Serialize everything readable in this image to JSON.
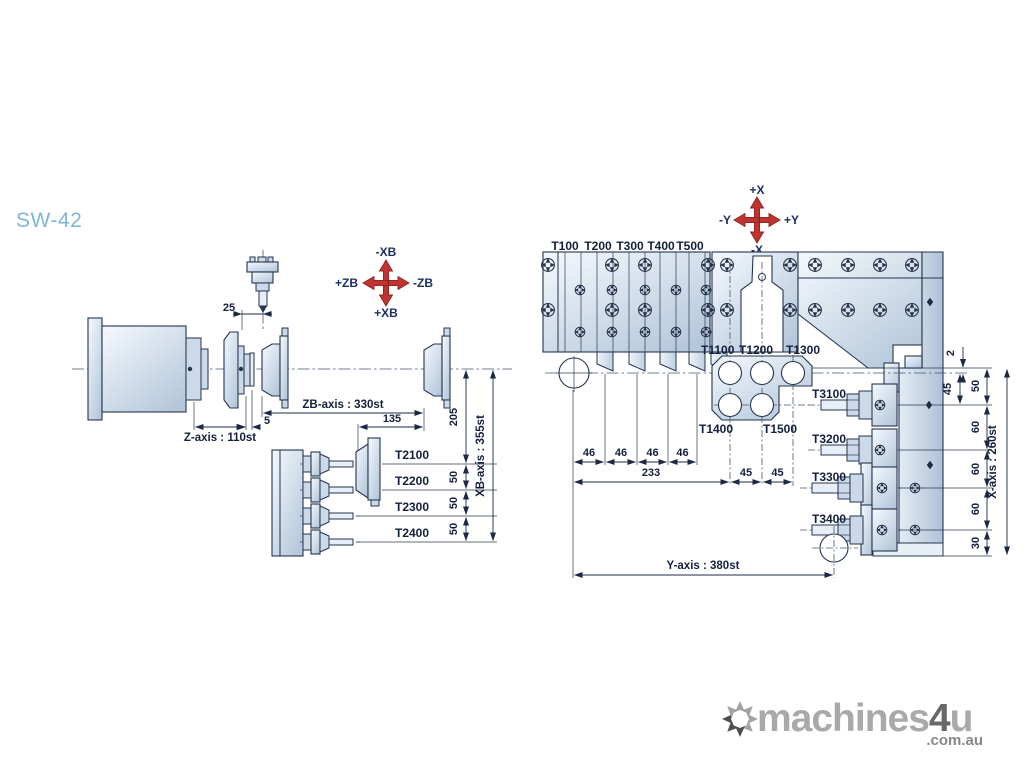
{
  "page": {
    "model_title": "SW-42"
  },
  "axis_cross_left": {
    "up": "-XB",
    "down": "+XB",
    "left": "+ZB",
    "right": "-ZB"
  },
  "axis_cross_right": {
    "up": "+X",
    "down": "-X",
    "left": "-Y",
    "right": "+Y"
  },
  "left_view": {
    "dim_25": "25",
    "dim_5": "5",
    "z_axis": "Z-axis : 110st",
    "zb_axis": "ZB-axis : 330st",
    "dim_135": "135",
    "dim_205": "205",
    "xb_axis": "XB-axis : 355st",
    "dims_50": [
      "50",
      "50",
      "50"
    ],
    "tools": [
      "T2100",
      "T2200",
      "T2300",
      "T2400"
    ]
  },
  "right_view": {
    "gang_tools": [
      "T100",
      "T200",
      "T300",
      "T400",
      "T500"
    ],
    "turret_tools_top": [
      "T1100",
      "T1200",
      "T1300"
    ],
    "turret_tools_bottom": [
      "T1400",
      "T1500"
    ],
    "back_tools": [
      "T3100",
      "T3200",
      "T3300",
      "T3400"
    ],
    "dims_46": [
      "46",
      "46",
      "46",
      "46"
    ],
    "dim_233": "233",
    "dims_45_h": [
      "45",
      "45"
    ],
    "y_axis": "Y-axis : 380st",
    "dim_2": "2",
    "dim_45_v": "45",
    "dims_x_chain": [
      "50",
      "60",
      "60",
      "60",
      "30"
    ],
    "x_axis": "X-axis : 260st"
  },
  "watermark": {
    "brand_machines": "machines",
    "brand_4": "4",
    "brand_u": "u",
    "domain": ".com.au"
  },
  "colors": {
    "title_blue": "#7fb5da",
    "cross_red": "#bf3330",
    "line_navy": "#25344f",
    "plate_fill_light": "#f5f9fd",
    "plate_fill_dark": "#b5c8db",
    "watermark_gray": "#a9a9a9"
  }
}
